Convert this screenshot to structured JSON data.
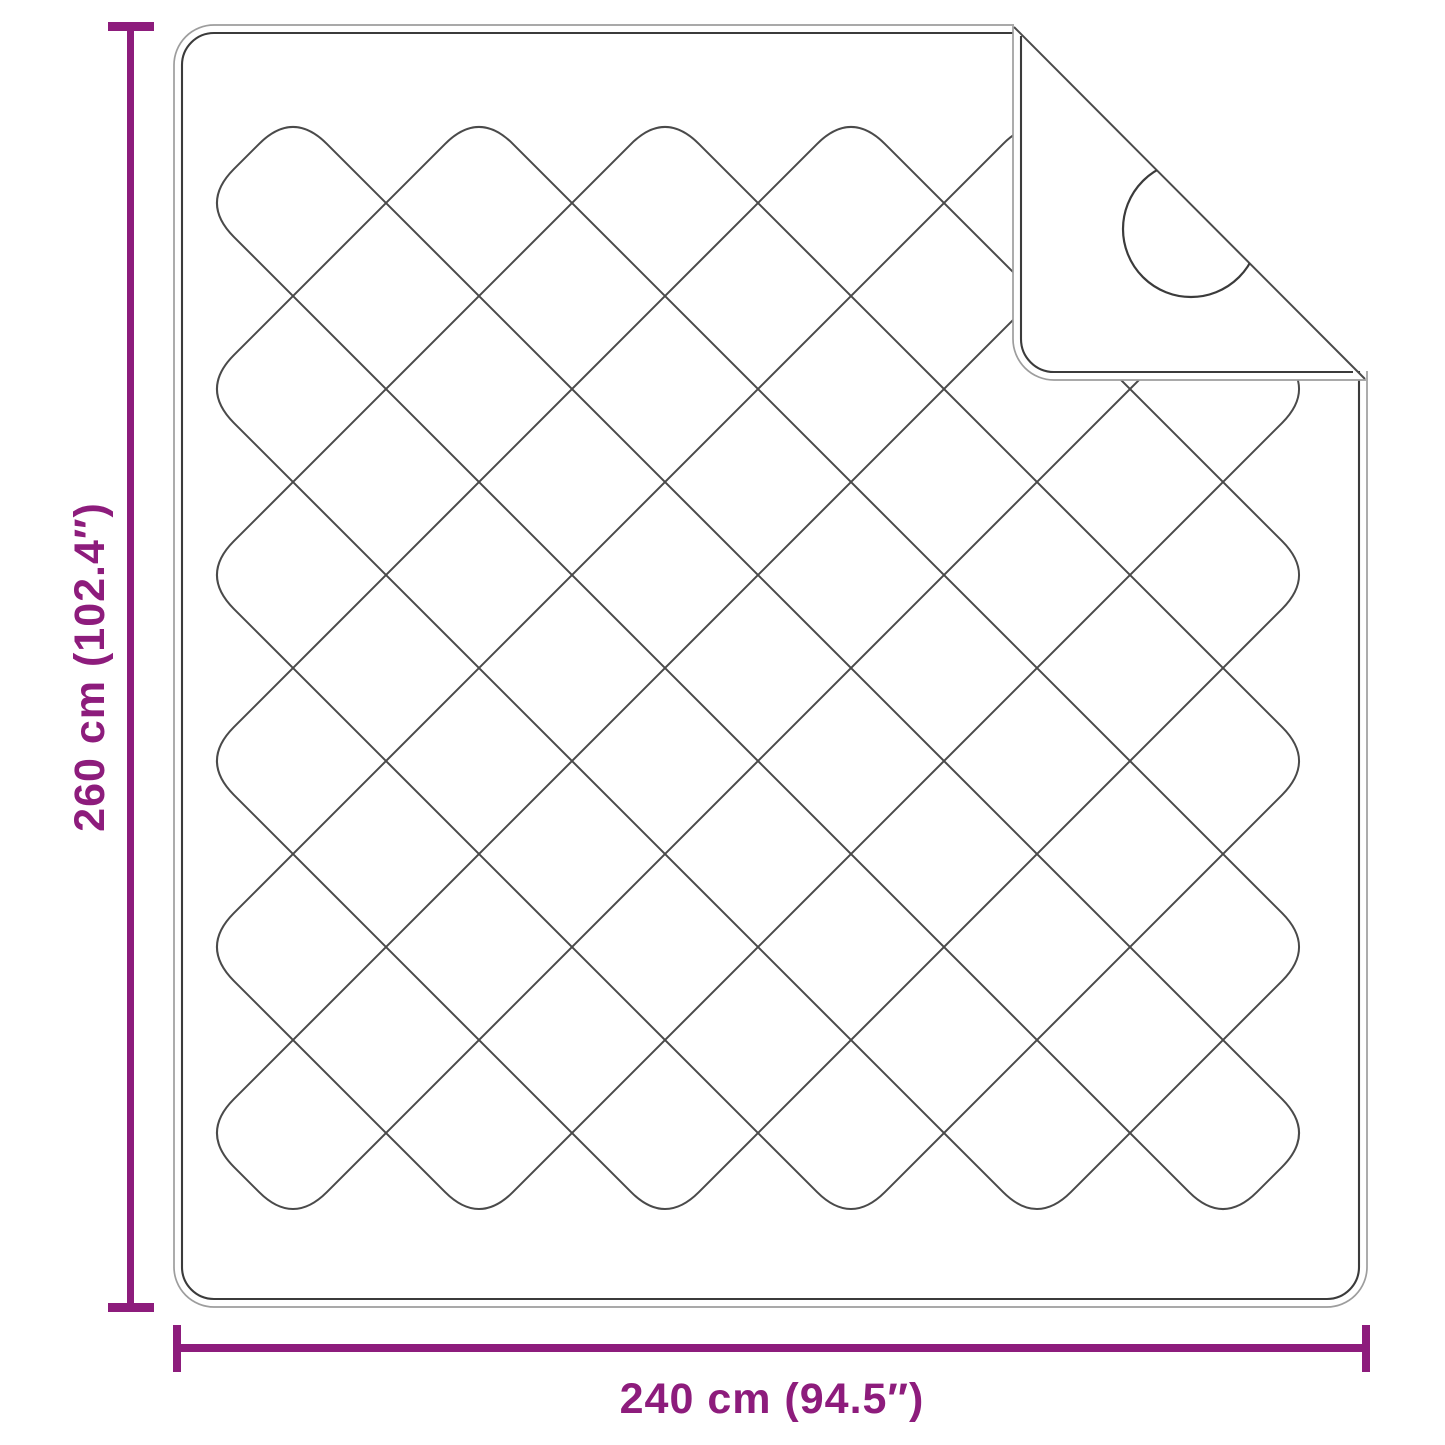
{
  "diagram": {
    "title": "quilted-blanket-dimension-diagram",
    "item": "quilted blanket with folded corner",
    "height_label": "260 cm (102.4″)",
    "width_label": "240 cm (94.5″)",
    "accent_color": "#8d1c7c",
    "outline_outer_color": "#9d9d9d",
    "outline_inner_color": "#3b3b3b",
    "stitch_line_color": "#4a4a4a",
    "background_color": "#ffffff",
    "blanket": {
      "x": 174,
      "y": 25,
      "width": 1193,
      "height": 1282,
      "corner_radius": 40,
      "seam_inset": 8
    },
    "pattern": {
      "xL": 200,
      "xR": 1316,
      "yT": 110,
      "yB": 1226,
      "spacing": 186,
      "fillet": 48,
      "loops": 6
    },
    "fold": {
      "crease_x1": 1014,
      "crease_y1": 27,
      "crease_x2": 1365,
      "crease_y2": 379
    },
    "snap_circle": {
      "cx": 1191,
      "cy": 229,
      "r": 68
    }
  }
}
